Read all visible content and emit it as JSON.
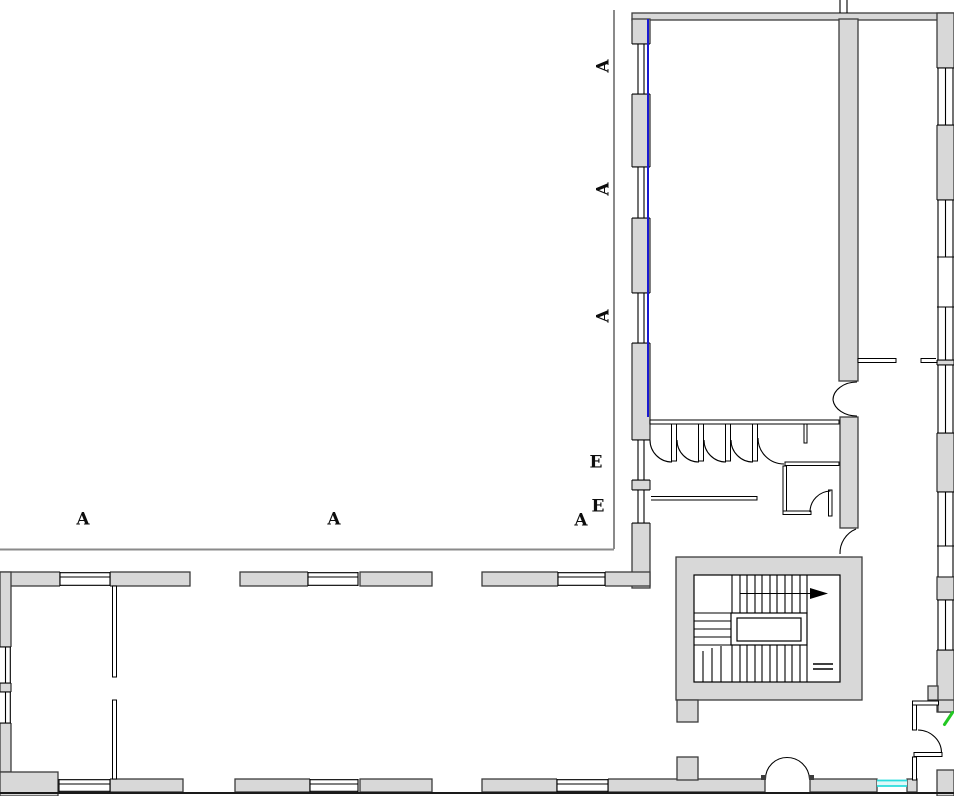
{
  "drawing": {
    "type": "architectural-floor-plan",
    "description": "CAD floor plan, L-shaped building corner with stairwell, toilet stalls, windows and door swings"
  },
  "colors": {
    "wall_fill": "#d8d8d8",
    "wall_edge": "#3c3c3c",
    "detail_line": "#000000",
    "blue": "#1a1ad1",
    "green": "#22c822",
    "cyan": "#2adddd",
    "reference_gray": "#8a8a8a"
  },
  "annotations": [
    {
      "id": "a-rot-1",
      "text": "A"
    },
    {
      "id": "a-rot-2",
      "text": "A"
    },
    {
      "id": "a-rot-3",
      "text": "A"
    },
    {
      "id": "e-1",
      "text": "E"
    },
    {
      "id": "e-2",
      "text": "E"
    },
    {
      "id": "a-bot-1",
      "text": "A"
    },
    {
      "id": "a-bot-2",
      "text": "A"
    },
    {
      "id": "a-bot-3",
      "text": "A"
    }
  ],
  "symbols": {
    "stair_arrow": "direction-of-travel arrow (up), pointing right",
    "level_mark": "double horizontal tick (floor level mark)"
  }
}
